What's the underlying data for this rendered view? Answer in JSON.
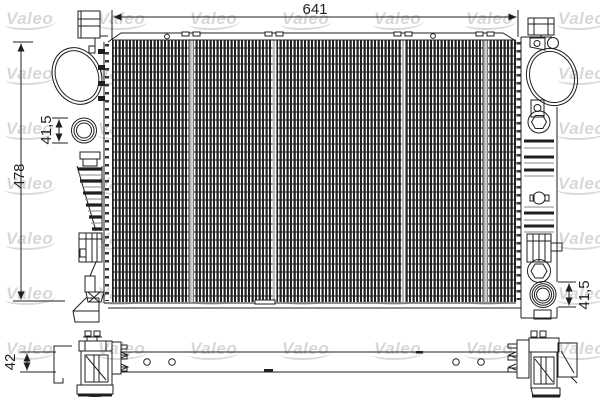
{
  "watermark": {
    "text": "Valeo"
  },
  "dimensions": {
    "overall_width": "641",
    "overall_height": "478",
    "left_port": "41,5",
    "right_port": "41,5",
    "core_thickness": "42"
  },
  "colors": {
    "line": "#1f1f1f",
    "line_soft": "#8a8a8a",
    "watermark": "#d8d8d8",
    "background": "#ffffff"
  }
}
